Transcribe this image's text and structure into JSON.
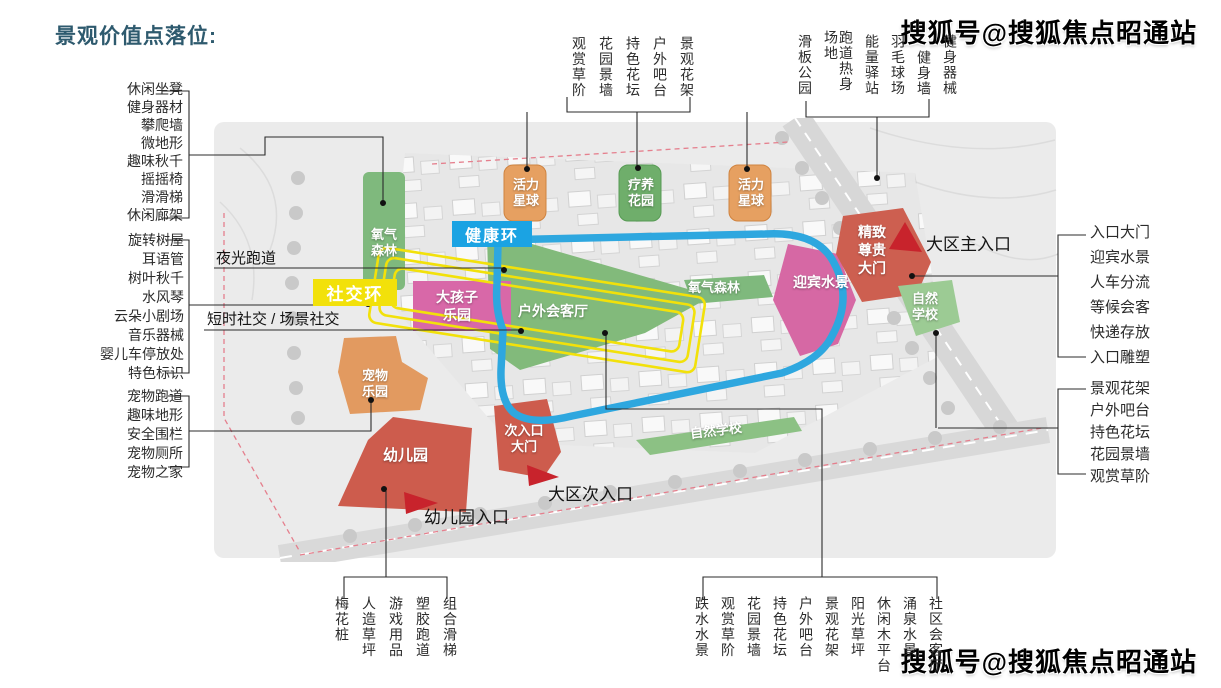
{
  "title": "景观价值点落位:",
  "watermark": "搜狐号@搜狐焦点昭通站",
  "left_groups": [
    {
      "items": [
        "休闲坐凳",
        "健身器材",
        "攀爬墙",
        "微地形",
        "趣味秋千",
        "摇摇椅",
        "滑滑梯",
        "休闲廊架"
      ]
    },
    {
      "items": [
        "旋转树屋",
        "耳语管",
        "树叶秋千",
        "水风琴",
        "云朵小剧场",
        "音乐器械",
        "婴儿车停放处",
        "特色标识"
      ]
    },
    {
      "items": [
        "宠物跑道",
        "趣味地形",
        "安全围栏",
        "宠物厕所",
        "宠物之家"
      ]
    }
  ],
  "top_groups": [
    {
      "items": [
        "观赏草阶",
        "花园景墙",
        "持色花坛",
        "户外吧台",
        "景观花架"
      ]
    },
    {
      "items": [
        "滑板公园",
        "跑道热身场地",
        "能量驿站",
        "羽毛球场",
        "健身墙",
        "健身器械"
      ]
    }
  ],
  "right_groups": [
    {
      "items": [
        "入口大门",
        "迎宾水景",
        "人车分流",
        "等候会客",
        "快递存放",
        "入口雕塑"
      ]
    },
    {
      "items": [
        "景观花架",
        "户外吧台",
        "持色花坛",
        "花园景墙",
        "观赏草阶"
      ]
    }
  ],
  "bottom_groups": [
    {
      "items": [
        "梅花桩",
        "人造草坪",
        "游戏用品",
        "塑胶跑道",
        "组合滑梯"
      ]
    },
    {
      "items": [
        "跌水水景",
        "观赏草阶",
        "花园景墙",
        "持色花坛",
        "户外吧台",
        "景观花架",
        "阳光草坪",
        "休闲木平台",
        "涌泉水景",
        "社区会客厅"
      ]
    }
  ],
  "map": {
    "badges": {
      "health_ring": "健康环",
      "social_ring": "社交环"
    },
    "zones": [
      {
        "label": "氧气森林"
      },
      {
        "label": "活力星球"
      },
      {
        "label": "疗养花园"
      },
      {
        "label": "活力星球"
      },
      {
        "label": "大孩子乐园"
      },
      {
        "label": "户外会客厅"
      },
      {
        "label": "氧气森林"
      },
      {
        "label": "迎宾水景"
      },
      {
        "label": "精致尊贵大门"
      },
      {
        "label": "自然学校"
      },
      {
        "label": "宠物乐园"
      },
      {
        "label": "幼儿园"
      },
      {
        "label": "次入口大门"
      },
      {
        "label": "自然学校"
      }
    ],
    "callouts": {
      "night_track": "夜光跑道",
      "short_social": "短时社交 / 场景社交",
      "main_entrance": "大区主入口",
      "sub_entrance": "大区次入口",
      "kindergarten_entrance": "幼儿园入口"
    },
    "colors": {
      "health_ring": "#1ba3e3",
      "social_ring": "#f2e10a",
      "forest_green": "#7fb97d",
      "orange_zone": "#e6a061",
      "pink_zone": "#d868a8",
      "red_zone": "#cd5c4d",
      "arrow_red": "#c8232c",
      "title_color": "#2e5a6e"
    }
  }
}
